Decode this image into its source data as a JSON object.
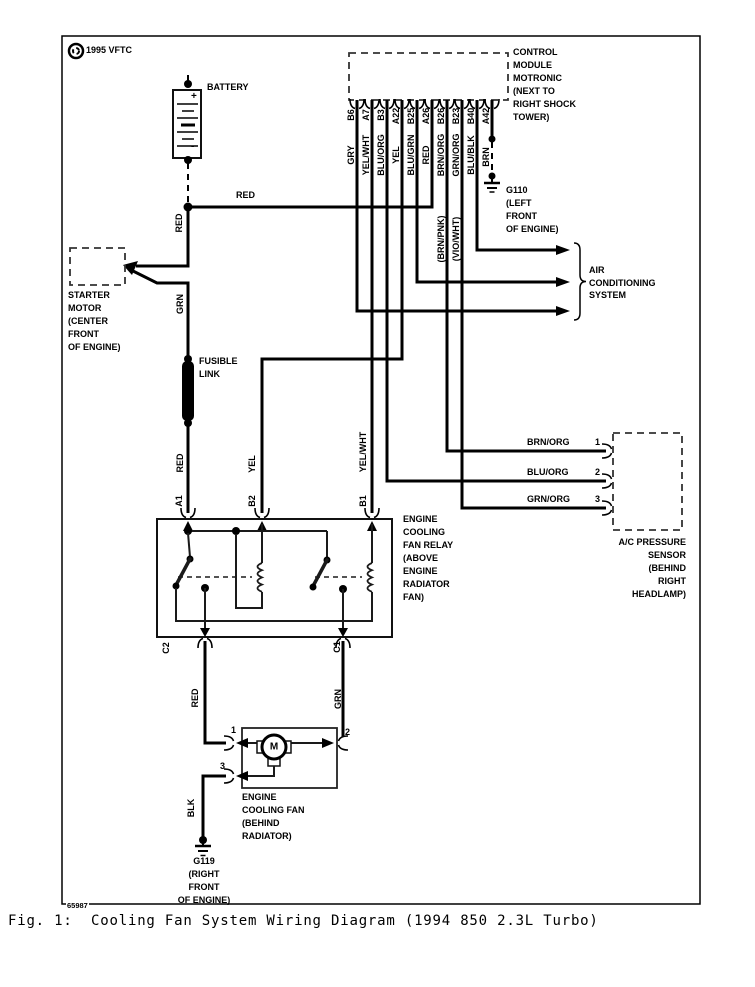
{
  "page": {
    "logo": "1995 VFTC",
    "doc_number": "65987",
    "caption": "Fig. 1:  Cooling Fan System Wiring Diagram (1994 850 2.3L Turbo)"
  },
  "battery": {
    "label": "BATTERY",
    "plus": "+",
    "minus": "-"
  },
  "module": {
    "text": [
      "CONTROL",
      "MODULE",
      "MOTRONIC",
      "(NEXT TO",
      "RIGHT SHOCK",
      "TOWER)"
    ],
    "pins": [
      {
        "id": "B6",
        "color": "GRY"
      },
      {
        "id": "A7",
        "color": "YEL/WHT"
      },
      {
        "id": "B3",
        "color": "BLU/ORG"
      },
      {
        "id": "A22",
        "color": "YEL"
      },
      {
        "id": "B25",
        "color": "BLU/GRN"
      },
      {
        "id": "A26",
        "color": "RED"
      },
      {
        "id": "B26",
        "color": "BRN/ORG"
      },
      {
        "id": "B23",
        "color": "GRN/ORG"
      },
      {
        "id": "B40",
        "color": "BLU/BLK"
      },
      {
        "id": "A42",
        "color": "BRN"
      }
    ],
    "alt_colors": [
      "(BRN/PNK)",
      "(VIO/WHT)"
    ]
  },
  "grounds": {
    "g110": [
      "G110",
      "(LEFT",
      "FRONT",
      "OF ENGINE)"
    ],
    "g119": [
      "G119",
      "(RIGHT",
      "FRONT",
      "OF ENGINE)"
    ]
  },
  "ac_system": [
    "AIR",
    "CONDITIONING",
    "SYSTEM"
  ],
  "starter": [
    "STARTER",
    "MOTOR",
    "(CENTER",
    "FRONT",
    "OF ENGINE)"
  ],
  "fusible_link": [
    "FUSIBLE",
    "LINK"
  ],
  "relay": {
    "text": [
      "ENGINE",
      "COOLING",
      "FAN RELAY",
      "(ABOVE",
      "ENGINE",
      "RADIATOR",
      "FAN)"
    ],
    "pin_a1": "A1",
    "pin_b2": "B2",
    "pin_b1": "B1",
    "pin_c2": "C2",
    "pin_c1": "C1"
  },
  "sensor": {
    "text": [
      "A/C PRESSURE",
      "SENSOR",
      "(BEHIND",
      "RIGHT",
      "HEADLAMP)"
    ],
    "pins": [
      {
        "num": "1",
        "color": "BRN/ORG"
      },
      {
        "num": "2",
        "color": "BLU/ORG"
      },
      {
        "num": "3",
        "color": "GRN/ORG"
      }
    ]
  },
  "fan": {
    "text": [
      "ENGINE",
      "COOLING FAN",
      "(BEHIND",
      "RADIATOR)"
    ],
    "motor": "M",
    "pin1": "1",
    "pin2": "2",
    "pin3": "3"
  },
  "wires": {
    "battery_feed": "RED",
    "battery_down": "RED",
    "starter_grn": "GRN",
    "link_red": "RED",
    "b2_yel": "YEL",
    "b1_yelwht": "YEL/WHT",
    "c2_red": "RED",
    "c1_grn": "GRN",
    "blk": "BLK"
  }
}
